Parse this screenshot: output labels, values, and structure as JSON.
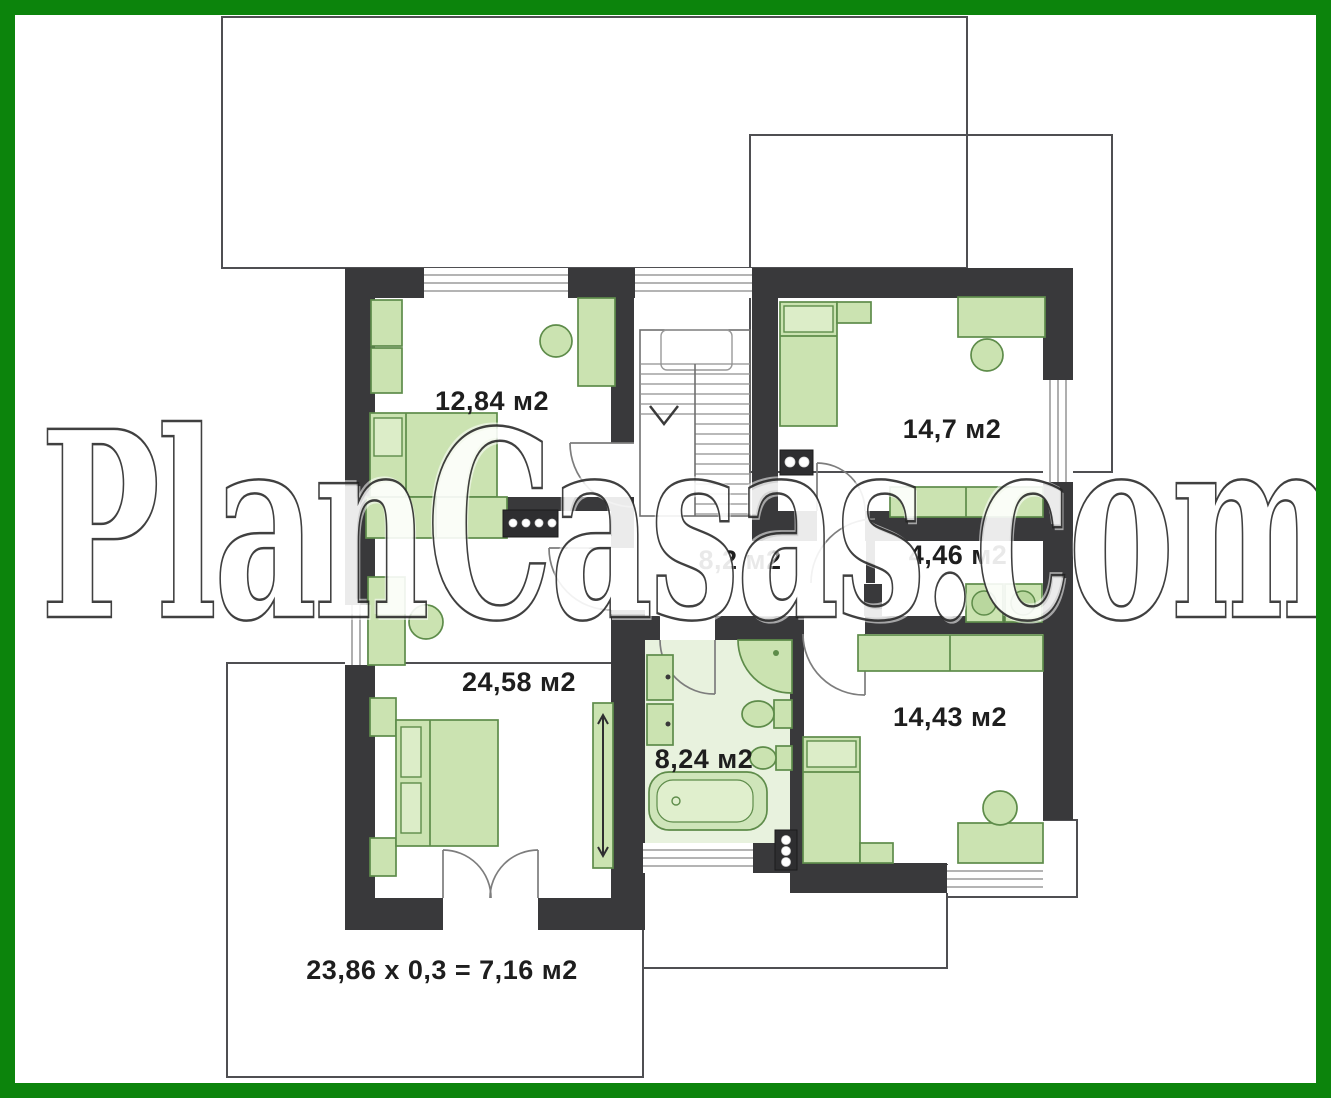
{
  "watermark": {
    "text": "PlanCasas.com"
  },
  "rooms": [
    {
      "name": "bedroom-upper-left",
      "area_label": "12,84 м2"
    },
    {
      "name": "bedroom-upper-right",
      "area_label": "14,7 м2"
    },
    {
      "name": "hallway",
      "area_label": "8,2 м2"
    },
    {
      "name": "laundry",
      "area_label": "4,46 м2"
    },
    {
      "name": "master-bedroom",
      "area_label": "24,58 м2"
    },
    {
      "name": "bathroom",
      "area_label": "8,24 м2"
    },
    {
      "name": "bedroom-lower-right",
      "area_label": "14,43 м2"
    }
  ],
  "annotations": {
    "terrace_area_formula": "23,86 x 0,3 = 7,16 м2"
  },
  "colors": {
    "frame": "#0c840c",
    "wall": "#39393b",
    "furniture_fill": "#cbe3b1",
    "furniture_stroke": "#5e8c4a",
    "bathroom_floor": "#e8f2de",
    "outline": "#4f4f52"
  }
}
